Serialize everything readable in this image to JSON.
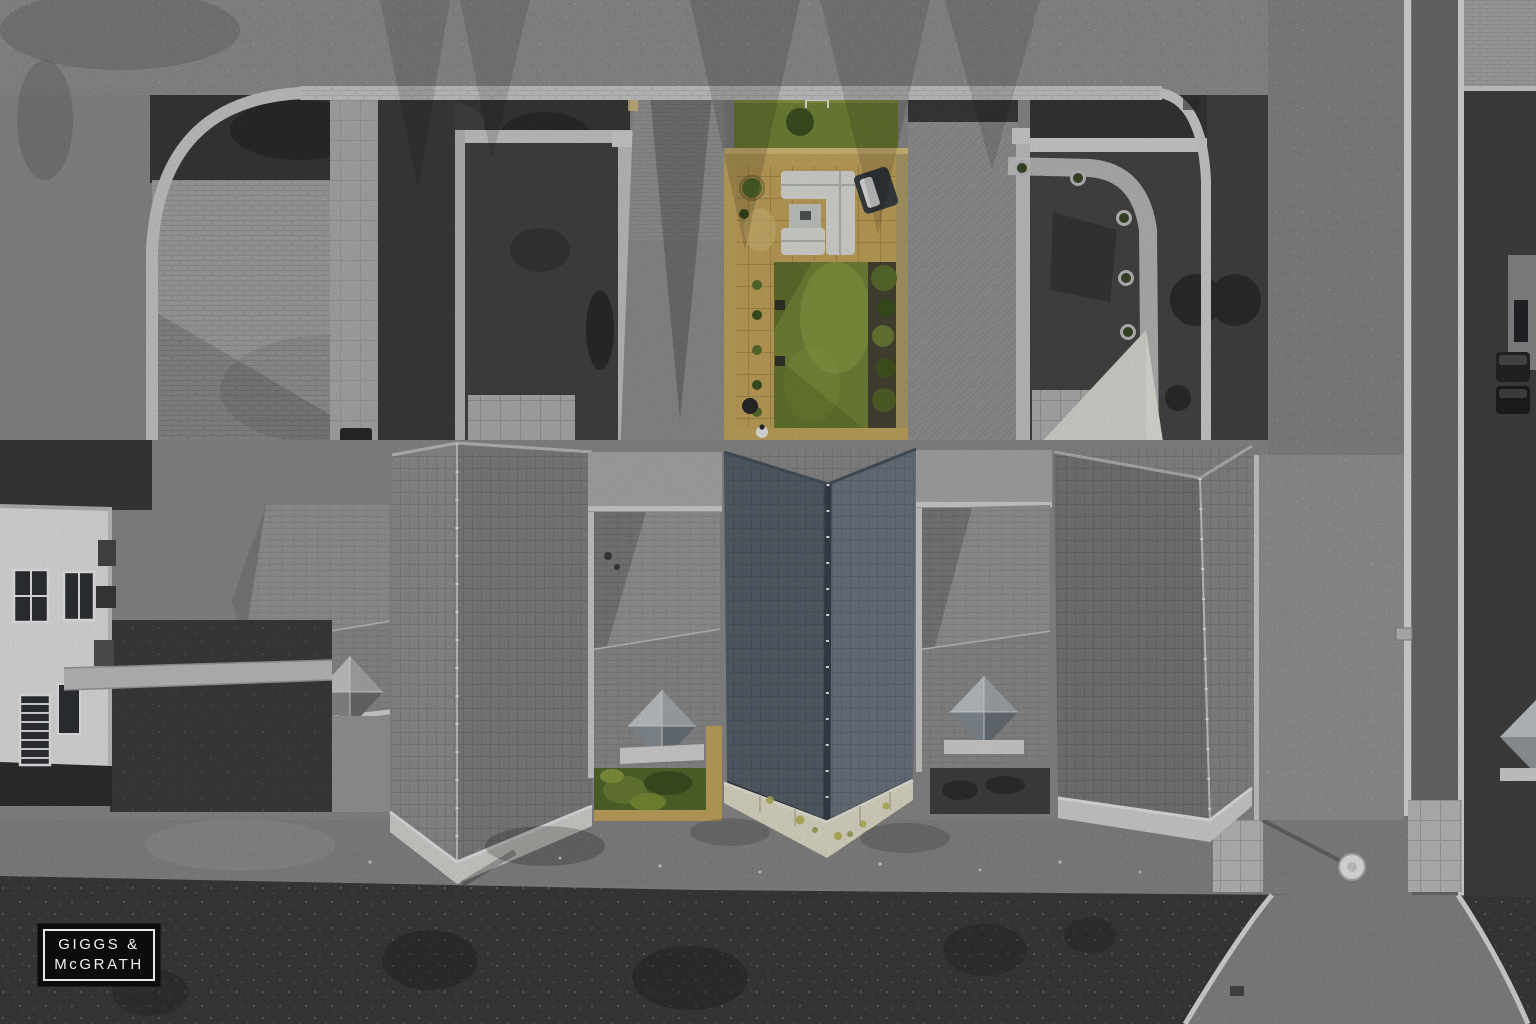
{
  "watermark": {
    "line1": "GIGGS &",
    "line2": "McGRATH"
  },
  "palette": {
    "logoBg": "#0c0c0c",
    "logoFrame": "#e6e6e6",
    "logoText": "#f2f2f2",
    "pavement": "#939393",
    "asphalt": "#8a8a8a",
    "asphaltDark": "#6f6f6f",
    "curb": "#e3e3e3",
    "gardenDark": "#454545",
    "verge": "#3d3d3d",
    "paving": "#a9a9a9",
    "brick": "#9a9a9a",
    "houseWhite": "#e9e9e9",
    "roofGrayL": "#949494",
    "roofGrayR": "#858585",
    "wingUpper": "#9d9d9d",
    "wingLower": "#929292",
    "stoneGray": "#dbdbd8",
    "slateL": "#59636e",
    "slateR": "#6f7a86",
    "ridgeNavy": "#39424e",
    "stoneCream": "#e9e4d0",
    "lichen": "#b9b64f",
    "lawn": "#77893a",
    "lawnLight": "#95a748",
    "patio": "#c9a95f",
    "patioLight": "#dcc27c",
    "wallTan": "#c9ac62",
    "shrub": "#5d7230",
    "shrubDark": "#3f5222",
    "sofa": "#e0e3de",
    "lounger": "#3a3e43",
    "sail": "#eceae4",
    "metalLight": "#c9cdd0",
    "metalDark": "#6f777e"
  }
}
